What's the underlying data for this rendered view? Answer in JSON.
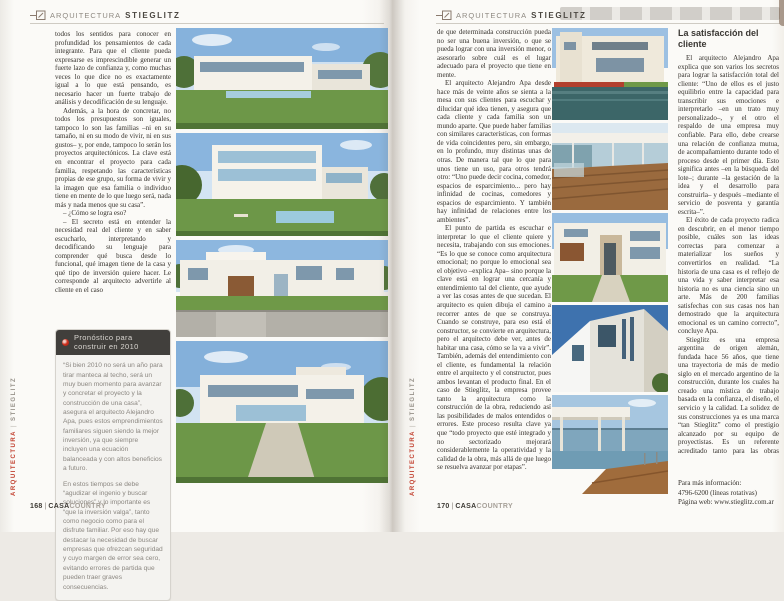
{
  "colors": {
    "accent_red": "#c2402f",
    "box_header_bg": "#413f3c",
    "page_bg": "#fbfaf7"
  },
  "header": {
    "section": "ARQUITECTURA",
    "client": "STIEGLITZ"
  },
  "margin_label": {
    "primary": "ARQUITECTURA",
    "separator": "|",
    "secondary": "STIEGLITZ"
  },
  "folio": {
    "separator": "|",
    "brand_bold": "CASA",
    "brand_light": "COUNTRY"
  },
  "left_page": {
    "folio_number": "168",
    "paragraphs": [
      "todos los sentidos para conocer en profundidad los pensamientos de cada integrante. Para que el cliente pueda expresarse es imprescindible generar un fuerte lazo de confianza y, como muchas veces lo que dice no es exactamente igual a lo que está pensando, es necesario hacer un fuerte trabajo de análisis y decodificación de su lenguaje.",
      "Además, a la hora de concretar, no todos los presupuestos son iguales, tampoco lo son las familias –ni en su tamaño, ni en su modo de vivir, ni en sus gustos– y, por ende, tampoco lo serán los proyectos arquitectónicos. La clave está en encontrar el proyecto para cada familia, respetando las características propias de ese grupo, su forma de vivir y la imagen que esa familia o individuo tiene en mente de lo que luego será, nada más y nada menos que su casa”.",
      "– ¿Cómo se logra eso?",
      "– El secreto está en entender la necesidad real del cliente y en saber escucharlo, interpretando y decodificando su lenguaje para comprender qué busca desde lo funcional, qué imagen tiene de la casa y qué tipo de inversión quiere hacer. Le corresponde al arquitecto advertirle al cliente en el caso"
    ],
    "forecast_box": {
      "title": "Pronóstico para construir en 2010",
      "paragraphs": [
        "“Si bien 2010 no será un año para tirar manteca al techo, será un muy buen momento para avanzar y concretar el proyecto y la construcción de una casa”, asegura el arquitecto Alejandro Apa, pues estos emprendimientos familiares siguen siendo la mejor inversión, ya que siempre incluyen una ecuación balanceada y con altos beneficios a futuro.",
        "En estos tiempos se debe “agudizar el ingenio y buscar soluciones” y lo importante es “que la inversión valga”, tanto como negocio como para el disfrute familiar. Por eso hay que destacar la necesidad de buscar empresas que ofrezcan seguridad y cuyo margen de error sea cero, evitando errores de partida que pueden traer graves consecuencias."
      ]
    },
    "photos": [
      {
        "alt": "Casa moderna blanca con jardín y piscina"
      },
      {
        "alt": "Casa vidriada de tres niveles con piscina"
      },
      {
        "alt": "Vista de calle de casa blanca con portón de madera"
      },
      {
        "alt": "Gran residencia moderna sobre parque"
      }
    ]
  },
  "right_page": {
    "folio_number": "170",
    "col1_paragraphs": [
      "de que determinada construcción pueda no ser una buena inversión, o que se pueda lograr con una inversión menor, o asesorarlo sobre cuál es el lugar adecuado para el proyecto que tiene en mente.",
      "El arquitecto Alejandro Apa desde hace más de veinte años se sienta a la mesa con sus clientes para escuchar y dilucidar qué idea tienen, y asegura que cada cliente y cada familia son un mundo aparte. Que puede haber familias con similares características, con formas de vida coincidentes pero, sin embargo, en lo profundo, muy distintas unas de otras. De manera tal que lo que para unos tiene un uso, para otros tendrá otro: “Uno puede decir cocina, comedor, espacios de esparcimiento... pero hay infinidad de cocinas, comedores y espacios de esparcimiento. Y también hay infinidad de relaciones entre los ambientes”.",
      "El punto de partida es escuchar e interpretar lo que el cliente quiere y necesita, trabajando con sus emociones. “Es lo que se conoce como arquitectura emocional; no porque lo emocional sea el objetivo –explica Apa– sino porque la clave está en lograr una cercanía y entendimiento tal del cliente, que ayude a ver las cosas antes de que sucedan. El arquitecto es quien dibuja el camino a recorrer antes de que se construya. Cuando se construye, para eso está el constructor, se convierte en arquitectura, pero el arquitecto debe ver, antes de habitar una casa, cómo se la va a vivir”. También, además del entendimiento con el cliente, es fundamental la relación entre el arquitecto y el constructor, pues ambos levantan el producto final. En el caso de Stieglitz, la empresa provee tanto la arquitectura como la construcción de la obra, reduciendo así las posibilidades de malos entendidos o errores. Este proceso resulta clave ya que “todo proyecto que esté integrado y no sectorizado mejorará considerablemente la operatividad y la calidad de la obra, más allá de que luego se resuelva avanzar por etapas”."
    ],
    "col2": {
      "heading": "La satisfacción del cliente",
      "paragraphs": [
        "El arquitecto Alejandro Apa explica que son varios los secretos para lograr la satisfacción total del cliente: “Uno de ellos es el justo equilibrio entre la capacidad para transcribir sus emociones e interpretarlo –en un trato muy personalizado–, y el otro el respaldo de una empresa muy confiable. Para ello, debe crearse una relación de confianza mutua, de acompañamiento durante todo el proceso desde el primer día. Esto significa antes –en la búsqueda del lote–; durante –la gestación de la idea y el desarrollo para construirla– y después –mediante el servicio de posventa y garantía escrita–”.",
        "El éxito de cada proyecto radica en descubrir, en el menor tiempo posible, cuáles son las ideas correctas para comenzar a materializar los sueños y convertirlos en realidad. “La historia de una casa es el reflejo de una vida y saber interpretar esa historia no es una ciencia sino un arte. Más de 200 familias satisfechas con sus casas nos han demostrado que la arquitectura emocional es un camino correcto”, concluye Apa.",
        "Stieglitz es una empresa argentina de origen alemán, fundada hace 56 años, que tiene una trayectoria de más de medio siglo en el mercado argentino de la construcción, durante los cuales ha creado una mística de trabajo basada en la confianza, el diseño, el servicio y la calidad. La solidez de sus construcciones ya es una marca “tan Stieglitz” como el prestigio alcanzado por su equipo de proyectistas. Es un referente acreditado tanto para las obras residenciales de mediana y gran escala como para las industriales, las institucionales y las comerciales. ■"
      ],
      "contact_lines": [
        "Para más información:",
        "4796-6200 (líneas rotativas)",
        "Página web: www.stieglitz.com.ar"
      ]
    },
    "photos": [
      {
        "alt": "Casa crema con reflejo en piscina"
      },
      {
        "alt": "Galería vidriada con deck de madera"
      },
      {
        "alt": "Acceso de casa con césped y sendero"
      },
      {
        "alt": "Vista en contrapicado de edificio blanco contra cielo azul"
      },
      {
        "alt": "Terraza al lago con piscina y deck de madera"
      }
    ]
  }
}
